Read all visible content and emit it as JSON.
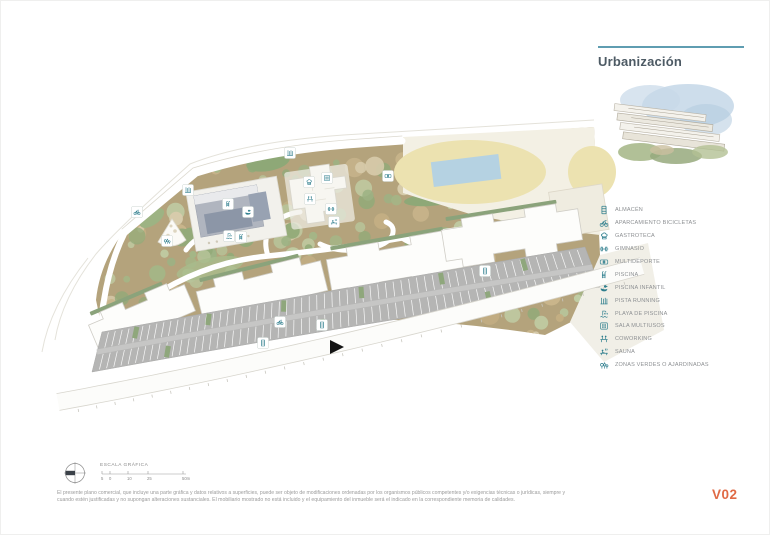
{
  "header": {
    "title": "Urbanización"
  },
  "legend": {
    "items": [
      {
        "icon": "almacen",
        "label": "ALMACÉN"
      },
      {
        "icon": "aparcamiento-bicicletas",
        "label": "APARCAMIENTO BICICLETAS"
      },
      {
        "icon": "gastroteca",
        "label": "GASTROTECA"
      },
      {
        "icon": "gimnasio",
        "label": "GIMNASIO"
      },
      {
        "icon": "multideporte",
        "label": "MULTIDEPORTE"
      },
      {
        "icon": "piscina",
        "label": "PISCINA"
      },
      {
        "icon": "piscina-infantil",
        "label": "PISCINA INFANTIL"
      },
      {
        "icon": "pista-running",
        "label": "PISTA RUNNING"
      },
      {
        "icon": "playa-de-piscina",
        "label": "PLAYA DE PISCINA"
      },
      {
        "icon": "sala-multiusos",
        "label": "SALA MULTIUSOS"
      },
      {
        "icon": "coworking",
        "label": "COWORKING"
      },
      {
        "icon": "sauna",
        "label": "SAUNA"
      },
      {
        "icon": "zonas-verdes",
        "label": "ZONAS VERDES O AJARDINADAS"
      }
    ]
  },
  "scale_bar": {
    "label": "ESCALA GRÁFICA",
    "ticks": [
      "5",
      "0",
      "10",
      "25",
      "50m"
    ]
  },
  "footer": {
    "disclaimer_line1": "El presente plano comercial, que incluye una parte gráfica y datos relativos a superficies, puede ser objeto de modificaciones ordenadas por los organismos públicos competentes y/o exigencias técnicas o jurídicas, siempre y",
    "disclaimer_line2": "cuando estén justificadas y no supongan alteraciones sustanciales. El mobiliario mostrado no está incluido y el equipamiento del inmueble será el indicado en la correspondiente memoria de calidades.",
    "version": "V02"
  },
  "colors": {
    "accent_teal": "#2e7e8d",
    "rule_blue": "#5f9db1",
    "version_orange": "#e06a45",
    "site_tan": "#b4a37c",
    "parking_gray": "#b5b5b4"
  },
  "plan": {
    "markers": [
      {
        "x": 137,
        "y": 212,
        "icon": "aparcamiento-bicicletas"
      },
      {
        "x": 188,
        "y": 190,
        "icon": "pista-running"
      },
      {
        "x": 290,
        "y": 153,
        "icon": "pista-running"
      },
      {
        "x": 388,
        "y": 176,
        "icon": "multideporte"
      },
      {
        "x": 309,
        "y": 182,
        "icon": "gastroteca"
      },
      {
        "x": 327,
        "y": 178,
        "icon": "sala-multiusos"
      },
      {
        "x": 310,
        "y": 199,
        "icon": "coworking"
      },
      {
        "x": 331,
        "y": 209,
        "icon": "gimnasio"
      },
      {
        "x": 334,
        "y": 222,
        "icon": "sauna"
      },
      {
        "x": 228,
        "y": 204,
        "icon": "piscina"
      },
      {
        "x": 248,
        "y": 212,
        "icon": "piscina-infantil"
      },
      {
        "x": 229,
        "y": 236,
        "icon": "playa-de-piscina"
      },
      {
        "x": 241,
        "y": 237,
        "icon": "piscina"
      },
      {
        "x": 167,
        "y": 241,
        "icon": "zonas-verdes"
      },
      {
        "x": 322,
        "y": 325,
        "icon": "almacen"
      },
      {
        "x": 485,
        "y": 271,
        "icon": "almacen"
      },
      {
        "x": 263,
        "y": 343,
        "icon": "almacen"
      },
      {
        "x": 280,
        "y": 322,
        "icon": "aparcamiento-bicicletas"
      }
    ]
  }
}
